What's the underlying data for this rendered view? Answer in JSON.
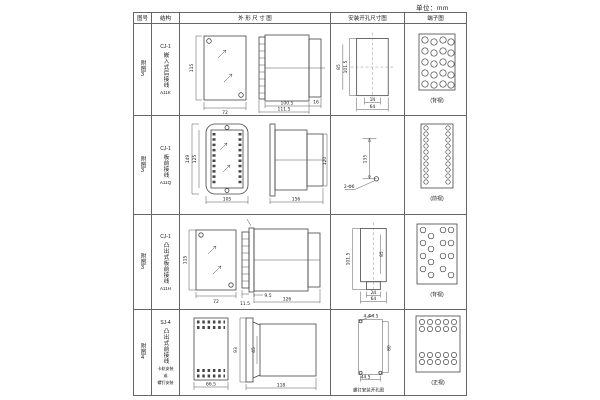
{
  "unit_label": "单位：mm",
  "header": {
    "col_figure": "图号",
    "col_structure": "结构",
    "col_outline": "外 形 尺 寸 图",
    "col_install": "安装开孔尺寸图",
    "col_terminal": "端子图"
  },
  "rows": [
    {
      "figure": "附图3",
      "model": "CJ-1",
      "structure_desc": "嵌入式后接线",
      "code": "A11K",
      "outline": {
        "height": "115",
        "width": "72",
        "depth1": "100.5",
        "depth2": "111.5",
        "side": "16"
      },
      "install": {
        "v1": "101.5",
        "v2": "85",
        "h1": "14",
        "h2": "64"
      },
      "terminal": {
        "caption": "(背视)"
      }
    },
    {
      "figure": "附图3",
      "model": "CJ-1",
      "structure_desc": "板前接线",
      "code": "A11Q",
      "outline": {
        "height1": "149",
        "height2": "125",
        "width": "105",
        "depth": "156",
        "side_h": "120"
      },
      "install": {
        "v": "135",
        "hole": "2-Φ6"
      },
      "terminal": {
        "caption": "(前视)"
      }
    },
    {
      "figure": "附图3",
      "model": "CJ-1",
      "structure_desc": "凸出式板前接线",
      "code": "A11H",
      "outline": {
        "height": "115",
        "width": "72",
        "d1": "11.5",
        "d2": "9.5",
        "depth": "126"
      },
      "install": {
        "v1": "101.5",
        "v2": "85",
        "h1": "24",
        "h2": "64"
      },
      "terminal": {
        "caption": "(背视)"
      }
    },
    {
      "figure": "附图4",
      "model": "SJ-4",
      "structure_desc": "凸出式前接线",
      "note1": "卡轨安装",
      "note2": "或",
      "note3": "螺钉安装",
      "outline": {
        "width": "66.5",
        "height": "93",
        "inner": "45",
        "depth": "118"
      },
      "install": {
        "hole": "4-Φ4.5",
        "v": "80",
        "h": "44.5",
        "caption": "螺钉安装开孔图"
      },
      "terminal": {
        "caption": "(正视)"
      }
    }
  ]
}
